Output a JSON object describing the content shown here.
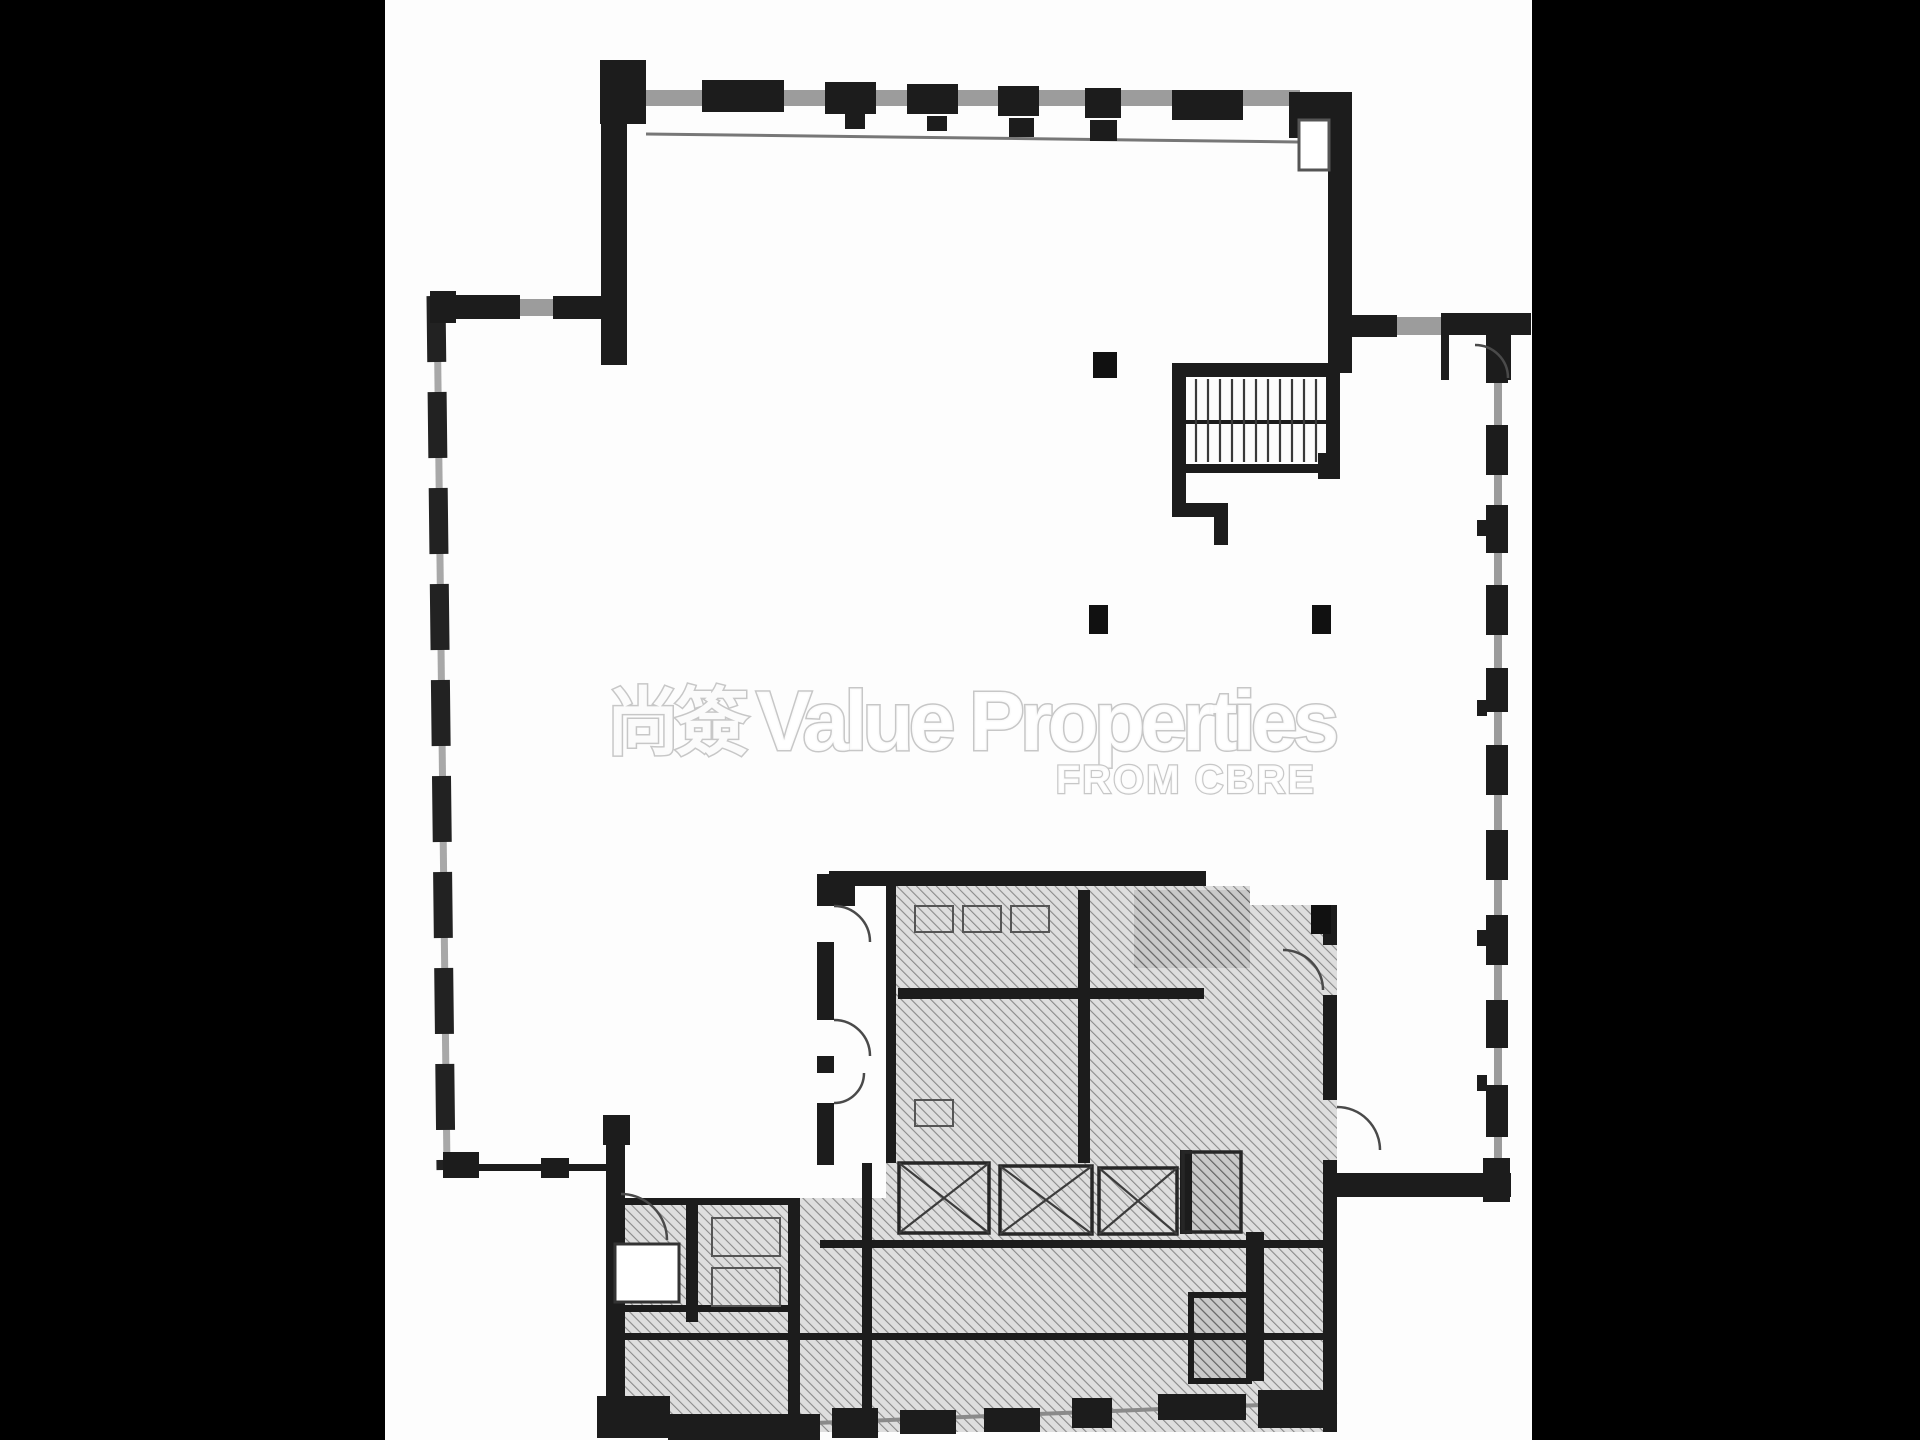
{
  "watermark": {
    "cjk": "尚簽",
    "main": "Value Properties",
    "sub": "FROM CBRE"
  },
  "colors": {
    "bar": "#000000",
    "paper": "#fdfdfd",
    "wall_dark": "#1c1c1c",
    "wall_gray": "#9c9c9c",
    "hatch_line": "#8a8a8a",
    "hatch_bg": "#dedede",
    "hatch_dark_line": "#636363",
    "column": "#111111",
    "arc": "#4a4a4a",
    "watermark_outline": "#c7c7c7"
  },
  "frame": {
    "left_bar": {
      "x": 0,
      "y": 0,
      "w": 385,
      "h": 1440
    },
    "right_bar": {
      "x": 1532,
      "y": 0,
      "w": 388,
      "h": 1440
    }
  },
  "plan": {
    "hatch_regions": [
      {
        "type": "poly",
        "points": "612,1198 886,1198 886,1163 1337,1163 1337,1432 612,1432",
        "tone": "light"
      },
      {
        "type": "rect",
        "x": 886,
        "y": 886,
        "w": 364,
        "h": 277,
        "tone": "light"
      },
      {
        "type": "rect",
        "x": 1250,
        "y": 905,
        "w": 87,
        "h": 258,
        "tone": "light"
      },
      {
        "type": "rect",
        "x": 1134,
        "y": 890,
        "w": 116,
        "h": 78,
        "tone": "dark"
      },
      {
        "type": "rect",
        "x": 1183,
        "y": 1152,
        "w": 58,
        "h": 80,
        "tone": "dark"
      },
      {
        "type": "rect",
        "x": 1191,
        "y": 1295,
        "w": 58,
        "h": 86,
        "tone": "dark"
      }
    ],
    "gray_walls": [
      [
        646,
        90,
        654,
        16
      ],
      [
        603,
        210,
        22,
        36
      ],
      [
        520,
        299,
        33,
        17
      ],
      [
        1397,
        317,
        44,
        18
      ],
      [
        1494,
        333,
        8,
        866
      ],
      [
        1380,
        1178,
        42,
        15
      ],
      [
        1332,
        190,
        17,
        16
      ],
      [
        1332,
        234,
        17,
        15
      ]
    ],
    "dark_walls": [
      [
        600,
        60,
        46,
        64
      ],
      [
        702,
        80,
        82,
        32
      ],
      [
        825,
        82,
        51,
        32
      ],
      [
        907,
        84,
        51,
        30
      ],
      [
        998,
        86,
        41,
        30
      ],
      [
        1085,
        88,
        36,
        30
      ],
      [
        1172,
        90,
        71,
        30
      ],
      [
        1289,
        92,
        63,
        46
      ],
      [
        845,
        114,
        20,
        15
      ],
      [
        927,
        116,
        20,
        15
      ],
      [
        1009,
        118,
        25,
        19
      ],
      [
        1090,
        120,
        27,
        21
      ],
      [
        601,
        124,
        26,
        241
      ],
      [
        1328,
        138,
        24,
        235
      ],
      [
        1352,
        315,
        45,
        22
      ],
      [
        1441,
        313,
        90,
        22
      ],
      [
        1441,
        335,
        8,
        45
      ],
      [
        1502,
        335,
        9,
        45
      ],
      [
        1486,
        333,
        22,
        50
      ],
      [
        1486,
        425,
        22,
        50
      ],
      [
        1486,
        505,
        22,
        48
      ],
      [
        1486,
        585,
        22,
        50
      ],
      [
        1486,
        668,
        22,
        44
      ],
      [
        1486,
        745,
        22,
        50
      ],
      [
        1486,
        830,
        22,
        50
      ],
      [
        1486,
        915,
        22,
        50
      ],
      [
        1486,
        1000,
        22,
        48
      ],
      [
        1486,
        1085,
        22,
        52
      ],
      [
        1483,
        1158,
        27,
        44
      ],
      [
        1477,
        520,
        10,
        16
      ],
      [
        1477,
        700,
        10,
        16
      ],
      [
        1477,
        930,
        10,
        16
      ],
      [
        1477,
        1075,
        10,
        16
      ],
      [
        1337,
        1173,
        174,
        24
      ],
      [
        430,
        291,
        26,
        32
      ],
      [
        453,
        295,
        67,
        24
      ],
      [
        553,
        296,
        58,
        23
      ],
      [
        443,
        1152,
        36,
        26
      ],
      [
        541,
        1158,
        28,
        20
      ],
      [
        443,
        1164,
        170,
        7
      ],
      [
        603,
        1115,
        27,
        30
      ],
      [
        606,
        1145,
        19,
        255
      ],
      [
        597,
        1396,
        73,
        42
      ],
      [
        668,
        1414,
        152,
        26
      ],
      [
        832,
        1408,
        46,
        30
      ],
      [
        900,
        1410,
        56,
        24
      ],
      [
        984,
        1408,
        56,
        24
      ],
      [
        1072,
        1398,
        40,
        30
      ],
      [
        1158,
        1394,
        88,
        26
      ],
      [
        1258,
        1390,
        79,
        38
      ],
      [
        829,
        871,
        377,
        15
      ],
      [
        817,
        874,
        38,
        32
      ],
      [
        817,
        886,
        17,
        20
      ],
      [
        817,
        942,
        17,
        78
      ],
      [
        817,
        1056,
        17,
        17
      ],
      [
        817,
        1103,
        17,
        62
      ],
      [
        886,
        886,
        10,
        277
      ],
      [
        1078,
        890,
        12,
        273
      ],
      [
        898,
        988,
        306,
        11
      ],
      [
        1323,
        905,
        14,
        40
      ],
      [
        1323,
        995,
        14,
        105
      ],
      [
        1323,
        1160,
        14,
        272
      ],
      [
        620,
        1198,
        180,
        7
      ],
      [
        612,
        1305,
        186,
        7
      ],
      [
        686,
        1200,
        12,
        122
      ],
      [
        788,
        1198,
        12,
        234
      ],
      [
        862,
        1163,
        10,
        269
      ],
      [
        612,
        1333,
        725,
        7
      ],
      [
        820,
        1240,
        517,
        8
      ],
      [
        1246,
        1232,
        18,
        149
      ],
      [
        1180,
        1150,
        12,
        84
      ],
      [
        1172,
        363,
        168,
        14
      ],
      [
        1172,
        363,
        14,
        112
      ],
      [
        1326,
        363,
        14,
        112
      ],
      [
        1186,
        420,
        140,
        4
      ],
      [
        1186,
        464,
        154,
        9
      ],
      [
        1172,
        473,
        14,
        42
      ],
      [
        1172,
        503,
        56,
        14
      ],
      [
        1214,
        517,
        14,
        28
      ],
      [
        1318,
        453,
        22,
        26
      ]
    ],
    "lines": [
      {
        "x1": 646,
        "y1": 134,
        "x2": 1298,
        "y2": 142,
        "stroke": "#777777",
        "w": 3
      },
      {
        "x1": 640,
        "y1": 1430,
        "x2": 1337,
        "y2": 1402,
        "stroke": "#8a8a8a",
        "w": 4
      },
      {
        "x1": 437,
        "y1": 298,
        "x2": 447,
        "y2": 1170,
        "stroke": "#a8a8a8",
        "w": 7
      },
      {
        "x1": 436,
        "y1": 296,
        "x2": 446,
        "y2": 1170,
        "stroke": "#222222",
        "w": 19,
        "dash": "66 30"
      }
    ],
    "outline_rects": [
      {
        "x": 615,
        "y": 1244,
        "w": 64,
        "h": 58,
        "stroke": "#333333",
        "sw": 3,
        "fill": "#ffffff"
      },
      {
        "x": 1299,
        "y": 120,
        "w": 30,
        "h": 50,
        "stroke": "#555555",
        "sw": 3,
        "fill": "#ffffff"
      },
      {
        "x": 915,
        "y": 906,
        "w": 38,
        "h": 26,
        "stroke": "#555555",
        "sw": 2,
        "fill": "none"
      },
      {
        "x": 963,
        "y": 906,
        "w": 38,
        "h": 26,
        "stroke": "#555555",
        "sw": 2,
        "fill": "none"
      },
      {
        "x": 1011,
        "y": 906,
        "w": 38,
        "h": 26,
        "stroke": "#555555",
        "sw": 2,
        "fill": "none"
      },
      {
        "x": 915,
        "y": 1100,
        "w": 38,
        "h": 26,
        "stroke": "#555555",
        "sw": 2,
        "fill": "none"
      },
      {
        "x": 712,
        "y": 1218,
        "w": 68,
        "h": 38,
        "stroke": "#555555",
        "sw": 2,
        "fill": "none"
      },
      {
        "x": 712,
        "y": 1268,
        "w": 68,
        "h": 38,
        "stroke": "#555555",
        "sw": 2,
        "fill": "none"
      },
      {
        "x": 1191,
        "y": 1295,
        "w": 58,
        "h": 86,
        "stroke": "#1c1c1c",
        "sw": 6,
        "fill": "none"
      }
    ],
    "lift_boxes": [
      {
        "x": 899,
        "y": 1163,
        "w": 90,
        "h": 70,
        "cross": true
      },
      {
        "x": 1000,
        "y": 1166,
        "w": 92,
        "h": 68,
        "cross": true
      },
      {
        "x": 1099,
        "y": 1168,
        "w": 78,
        "h": 66,
        "cross": true
      },
      {
        "x": 1183,
        "y": 1152,
        "w": 58,
        "h": 80,
        "cross": false
      }
    ],
    "stair_treads": {
      "x1": 1196,
      "x2": 1318,
      "step": 12,
      "y1": 379,
      "y2": 462
    },
    "columns": [
      [
        1093,
        352,
        24,
        26
      ],
      [
        1089,
        605,
        19,
        29
      ],
      [
        1312,
        605,
        19,
        29
      ],
      [
        1311,
        905,
        20,
        29
      ]
    ],
    "arcs": [
      {
        "d": "M 834 906 a 36 36 0 0 1 36 36"
      },
      {
        "d": "M 834 1020 a 36 36 0 0 1 36 36"
      },
      {
        "d": "M 834 1103 a 30 30 0 0 0 30 -30"
      },
      {
        "d": "M 1323 990 a 40 40 0 0 0 -40 -40"
      },
      {
        "d": "M 1337 1107 a 43 43 0 0 1 43 43"
      },
      {
        "d": "M 667 1240 a 46 46 0 0 0 -46 -46"
      },
      {
        "d": "M 1508 378 a 33 33 0 0 0 -33 -33"
      }
    ]
  }
}
